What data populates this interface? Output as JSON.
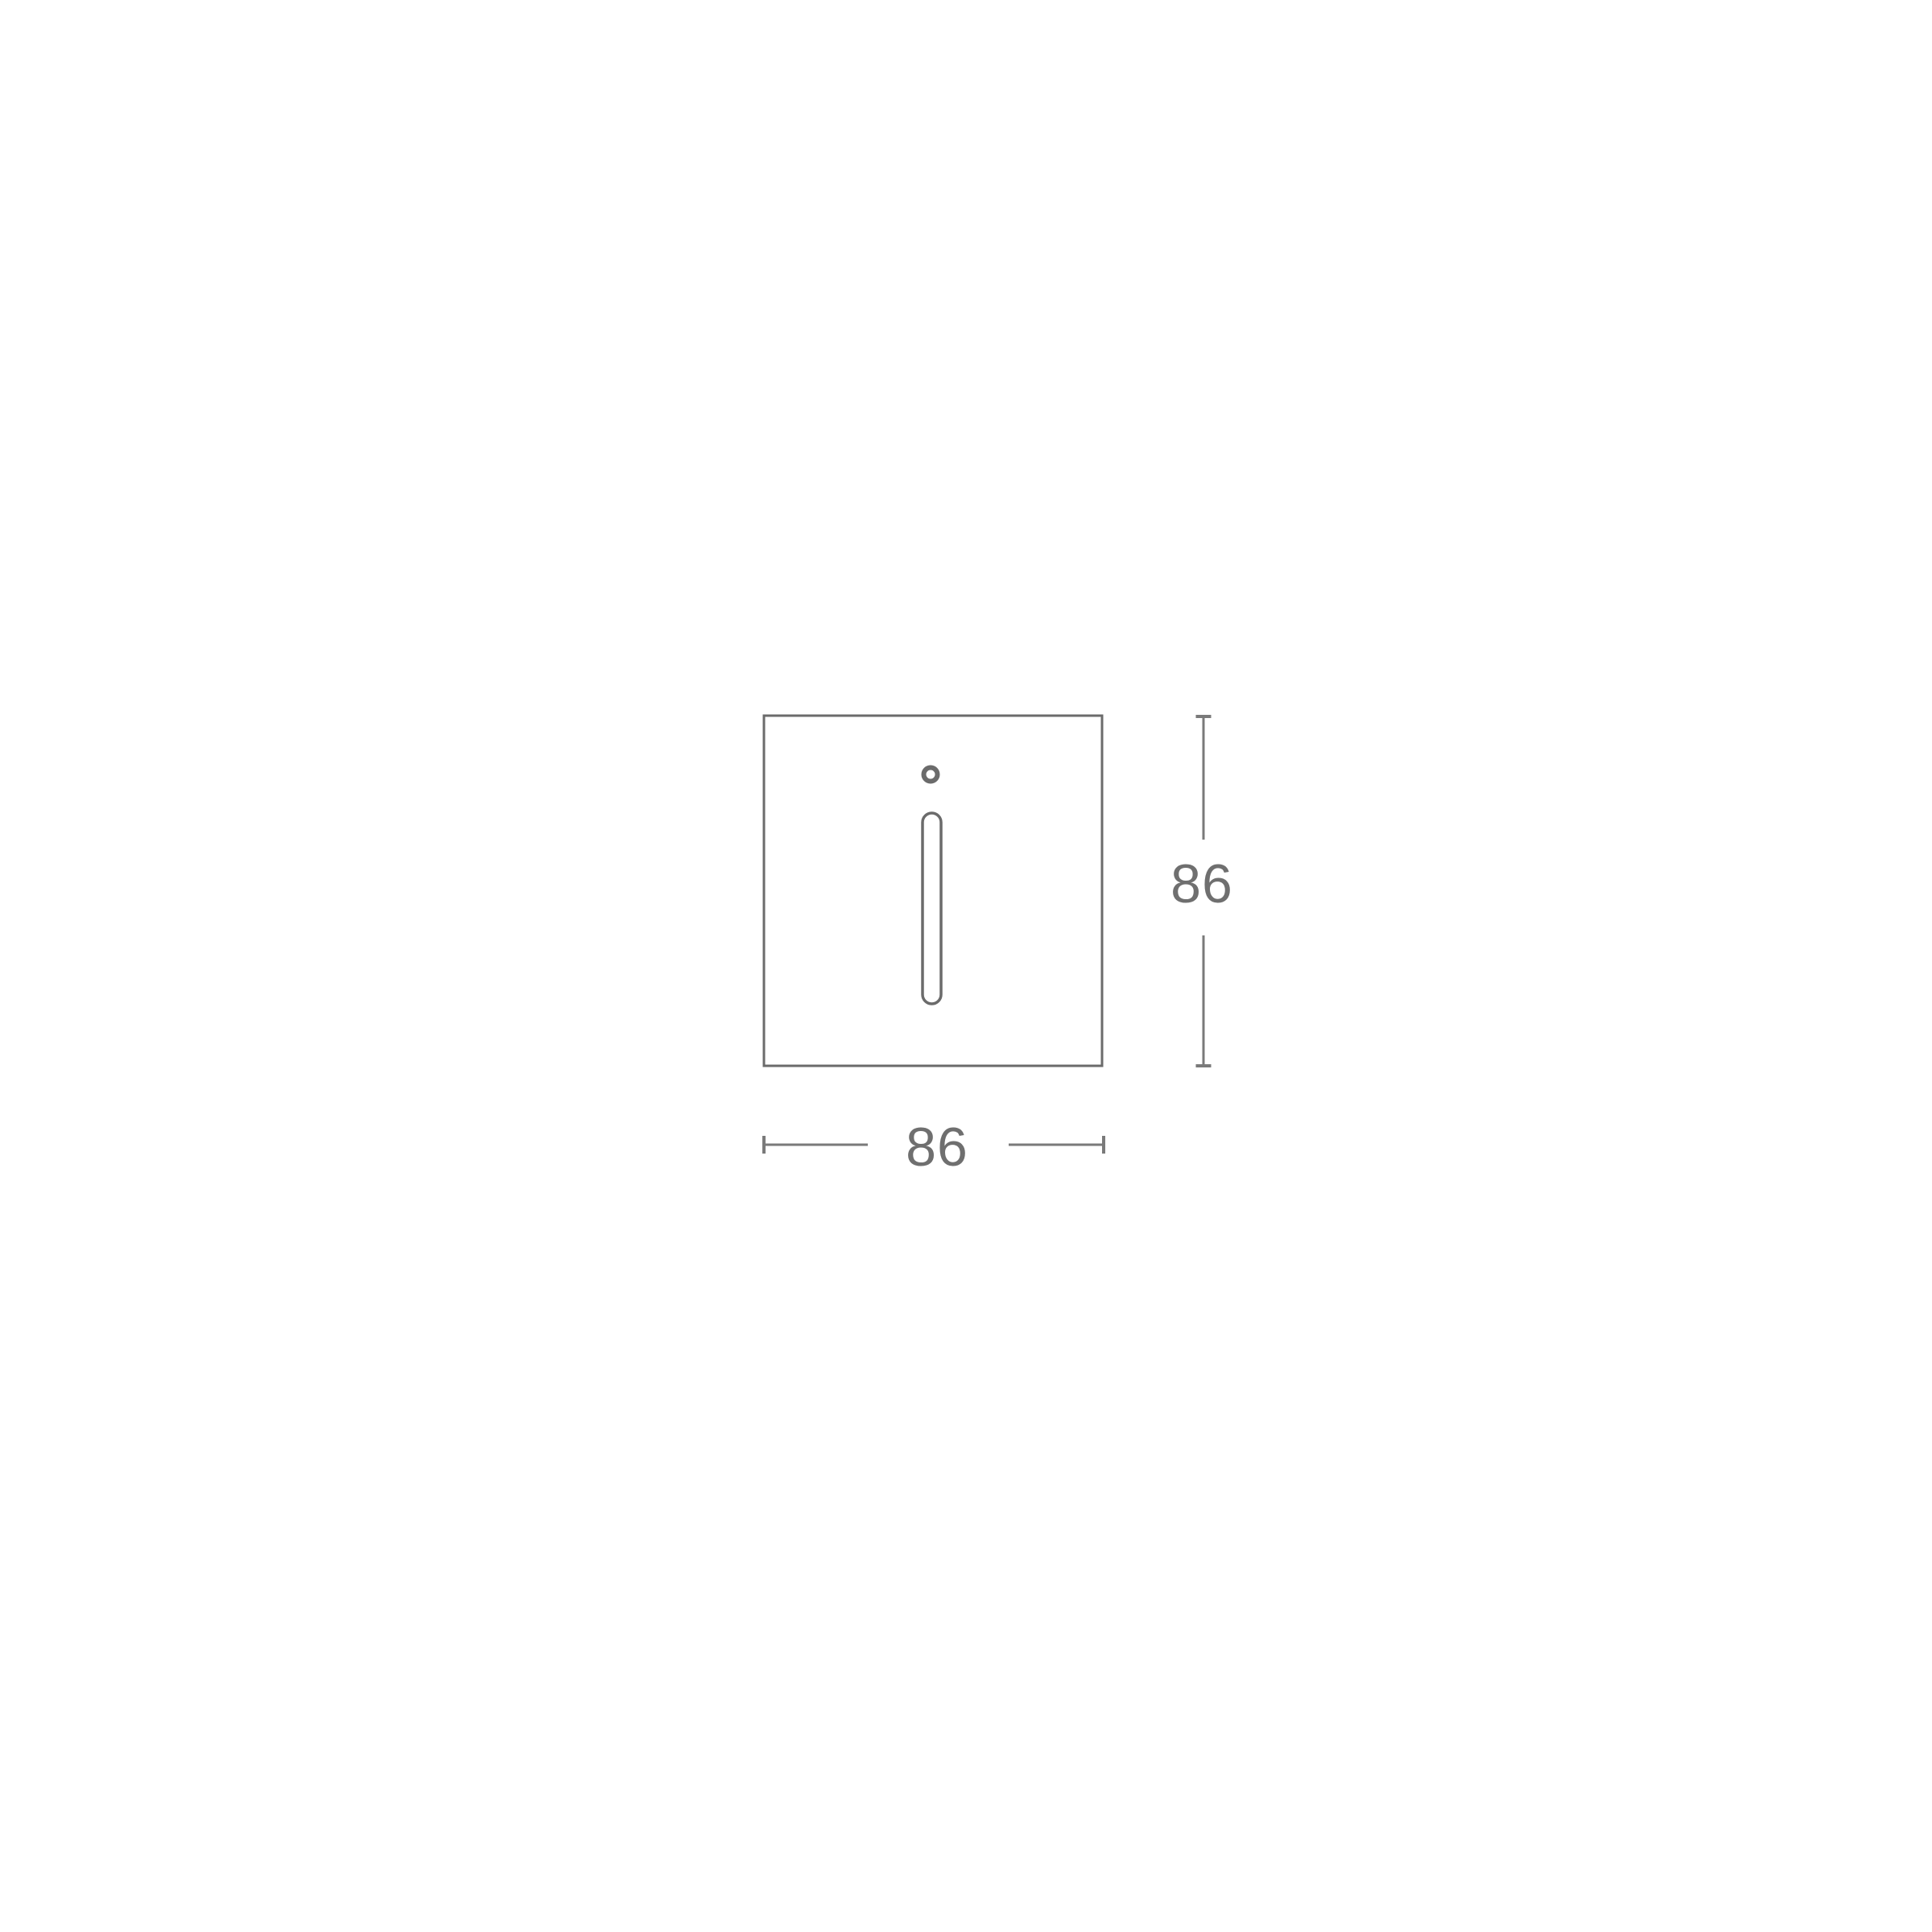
{
  "colors": {
    "bg": "#ffffff",
    "line": "#6b6b6b",
    "dim": "#7a7a7a",
    "text": "#6f6f6f"
  },
  "drawing": {
    "type": "technical-dimension-drawing",
    "subject": "square faceplate with round hole and vertical light slot"
  },
  "dimensions": {
    "width": {
      "label": "86",
      "value": 86
    },
    "height": {
      "label": "86",
      "value": 86
    }
  }
}
